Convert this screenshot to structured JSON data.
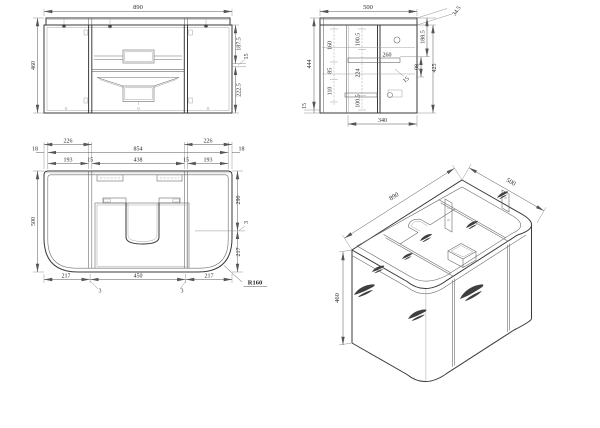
{
  "views": {
    "front": {
      "width": "890",
      "height": "460",
      "right_top": "187.5",
      "right_mid": "15",
      "right_bottom": "222.5"
    },
    "side": {
      "width": "500",
      "height": "444",
      "bottom_left": "15",
      "col1": [
        "160",
        "85",
        "110"
      ],
      "col2": [
        "100.5",
        "224",
        "100.5"
      ],
      "slide": "260",
      "top_right": "34.5",
      "right_a": "188.5",
      "right_b": "98",
      "right_c": "425",
      "inner_leader": "15",
      "bottom": "340"
    },
    "plan": {
      "left_wall": "18",
      "right_wall": "18",
      "top_left": "226",
      "top_span": "854",
      "top_right": "226",
      "row2": [
        "193",
        "15",
        "438",
        "15",
        "193"
      ],
      "depth": "500",
      "right_a": "290",
      "right_b": "3",
      "right_c": "217",
      "bottom_a": "217",
      "bottom_b": "450",
      "bottom_c": "217",
      "gap_a": "3",
      "gap_b": "3",
      "radius": "R160"
    },
    "iso": {
      "length": "890",
      "depth": "500",
      "height": "460"
    }
  }
}
